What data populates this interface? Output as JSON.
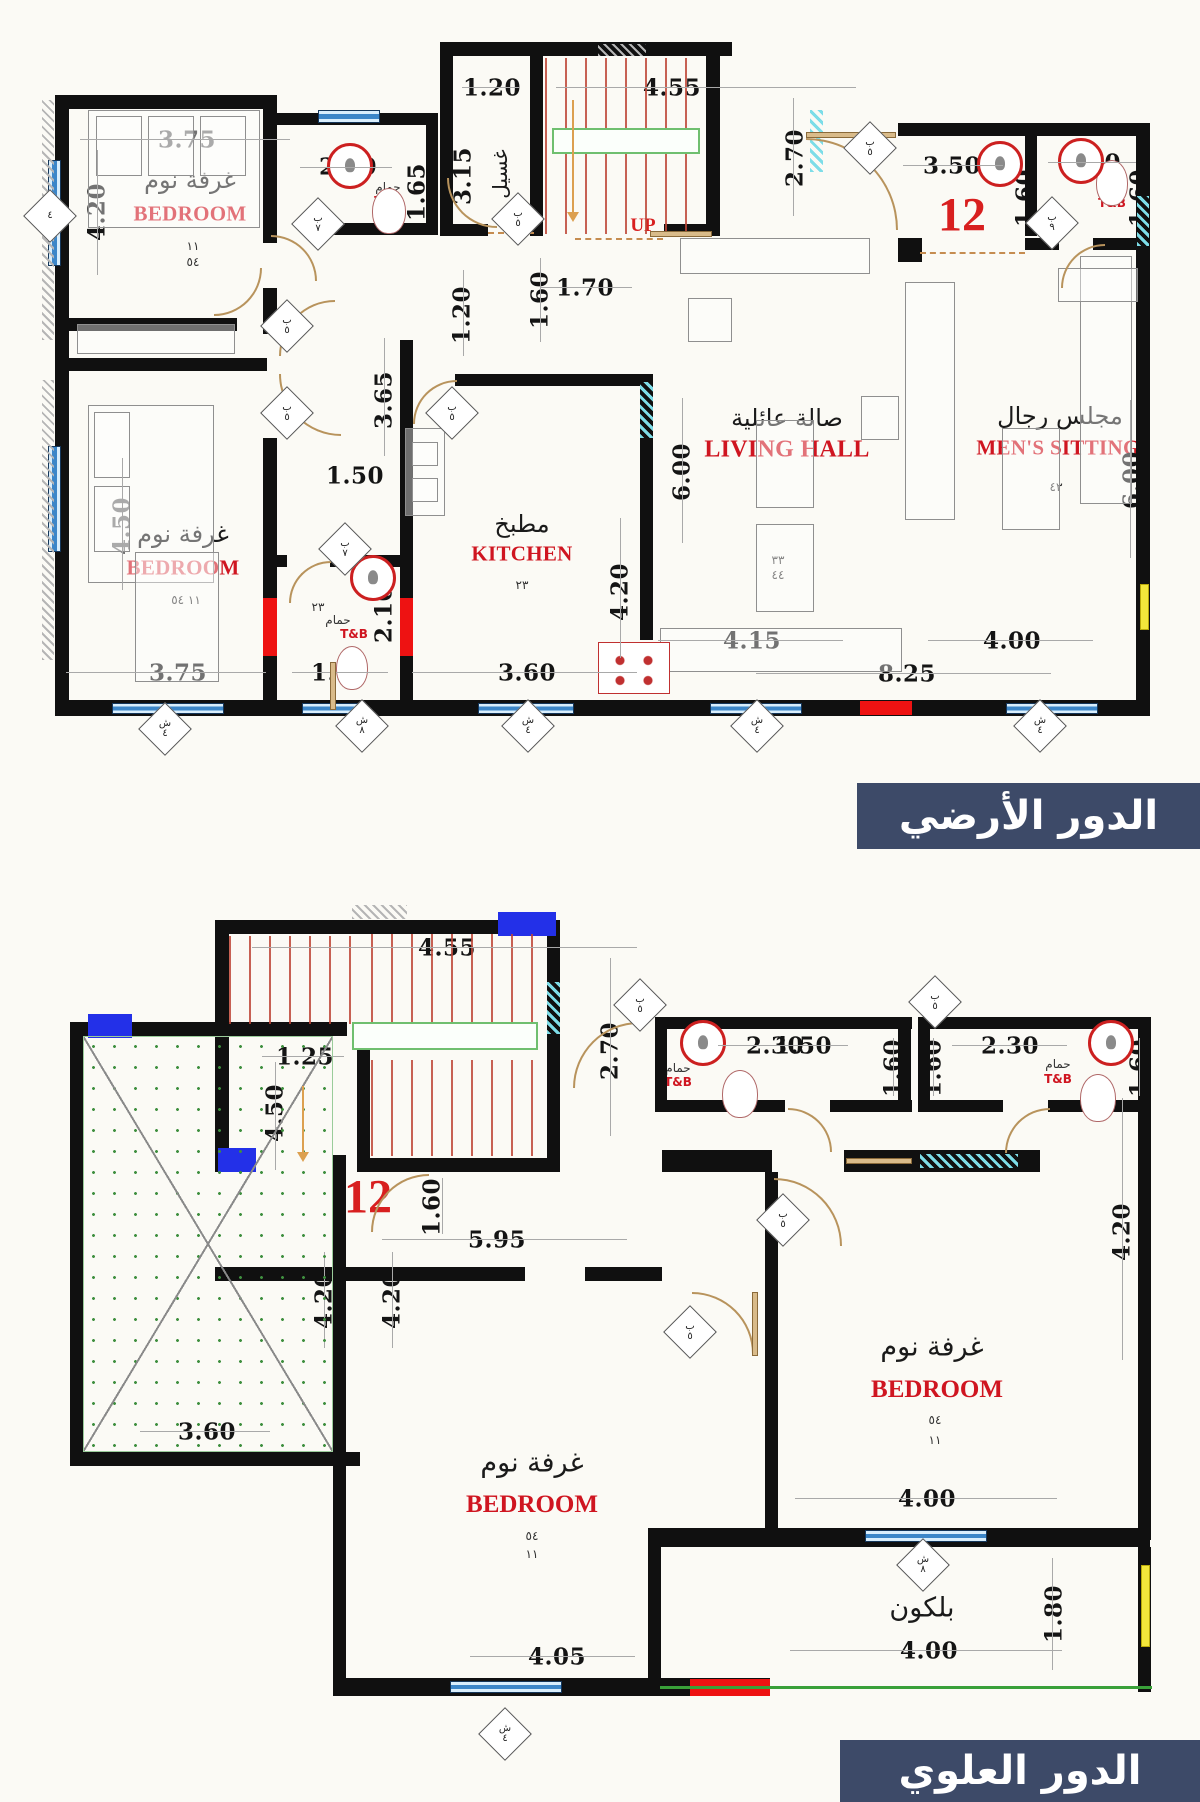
{
  "unit_number": "12",
  "floor_titles": {
    "ground": "الدور الأرضي",
    "upper": "الدور العلوي"
  },
  "ground": {
    "bedroom1": {
      "name_ar": "غرفة نوم",
      "name_en": "BEDROOM",
      "code1": "١١",
      "code2": "٥٤",
      "width": "3.75",
      "height": "4.20"
    },
    "tb1": {
      "name_ar": "حمام",
      "name_en": "T&B",
      "code": "٢٢",
      "width": "2.00",
      "height": "1.65"
    },
    "laundry": {
      "name_ar": "غسيل",
      "width": "1.20",
      "height": "3.15"
    },
    "stairs": {
      "up": "UP",
      "width": "4.55",
      "height": "2.70"
    },
    "entry": {
      "width": "3.50",
      "height": "1.60"
    },
    "tb2": {
      "name_ar": "حمام",
      "name_en": "T&B",
      "width": "1.70",
      "height": "1.60"
    },
    "hall": {
      "d_170": "1.70",
      "d_120": "1.20",
      "d_160": "1.60",
      "d_365": "3.65",
      "d_150": "1.50"
    },
    "bedroom2": {
      "name_ar": "غرفة نوم",
      "name_en": "BEDROOM",
      "code": "١١ ٥٤",
      "width": "3.75",
      "height": "4.50"
    },
    "tb3": {
      "name_ar": "حمام",
      "name_en": "T&B",
      "code": "٢٣",
      "width": "1.50",
      "height": "2.10"
    },
    "kitchen": {
      "name_ar": "مطبخ",
      "name_en": "KITCHEN",
      "code": "٢٣",
      "width": "3.60",
      "height": "4.20"
    },
    "living": {
      "name_ar": "صالة عائلية",
      "name_en": "LIVING HALL",
      "code1": "٣٣",
      "code2": "٤٤",
      "height": "6.00",
      "d_415": "4.15",
      "d_825": "8.25"
    },
    "mens": {
      "name_ar": "مجلس رجال",
      "name_en": "MEN'S SITTING",
      "code": "٤٣",
      "height": "6.00",
      "width": "4.00"
    }
  },
  "upper": {
    "stairs": {
      "width": "4.55",
      "height": "2.70",
      "d_125": "1.25",
      "d_450": "4.50"
    },
    "hall": {
      "d_160": "1.60",
      "d_595": "5.95"
    },
    "tba": {
      "name_ar": "حمام",
      "name_en": "T&B",
      "d1": "2.30",
      "d2": "1.50",
      "side": "1.60"
    },
    "tbb": {
      "name_ar": "حمام",
      "name_en": "T&B",
      "d1": "2.30",
      "side_l": "1.60",
      "side_r": "1.60"
    },
    "terrace": {
      "width": "3.60",
      "height": "4.20"
    },
    "bedroom_mid": {
      "name_ar": "غرفة نوم",
      "name_en": "BEDROOM",
      "code1": "٥٤",
      "code2": "١١",
      "width": "4.05",
      "height": "4.20"
    },
    "bedroom_right": {
      "name_ar": "غرفة نوم",
      "name_en": "BEDROOM",
      "code1": "٥٤",
      "code2": "١١",
      "width": "4.00",
      "height": "4.20"
    },
    "balcony": {
      "name_ar": "بلكون",
      "width": "4.00",
      "height": "1.80"
    }
  },
  "tags": [
    {
      "a": "",
      "b": "٤"
    },
    {
      "a": "ب",
      "b": "٧"
    },
    {
      "a": "ب",
      "b": "٥"
    },
    {
      "a": "ب",
      "b": "٥"
    },
    {
      "a": "ب",
      "b": "٥"
    },
    {
      "a": "ب",
      "b": "٥"
    },
    {
      "a": "ب",
      "b": "٧"
    },
    {
      "a": "ب",
      "b": "٥"
    },
    {
      "a": "ب",
      "b": "٩"
    },
    {
      "a": "ش",
      "b": "٤"
    },
    {
      "a": "ش",
      "b": "٨"
    },
    {
      "a": "ش",
      "b": "٤"
    },
    {
      "a": "ش",
      "b": "٤"
    },
    {
      "a": "ش",
      "b": "٤"
    },
    {
      "a": "ب",
      "b": "٥"
    },
    {
      "a": "ب",
      "b": "٥"
    },
    {
      "a": "ب",
      "b": "٥"
    },
    {
      "a": "ب",
      "b": "٥"
    },
    {
      "a": "ش",
      "b": "٨"
    },
    {
      "a": "ش",
      "b": "٤"
    }
  ]
}
